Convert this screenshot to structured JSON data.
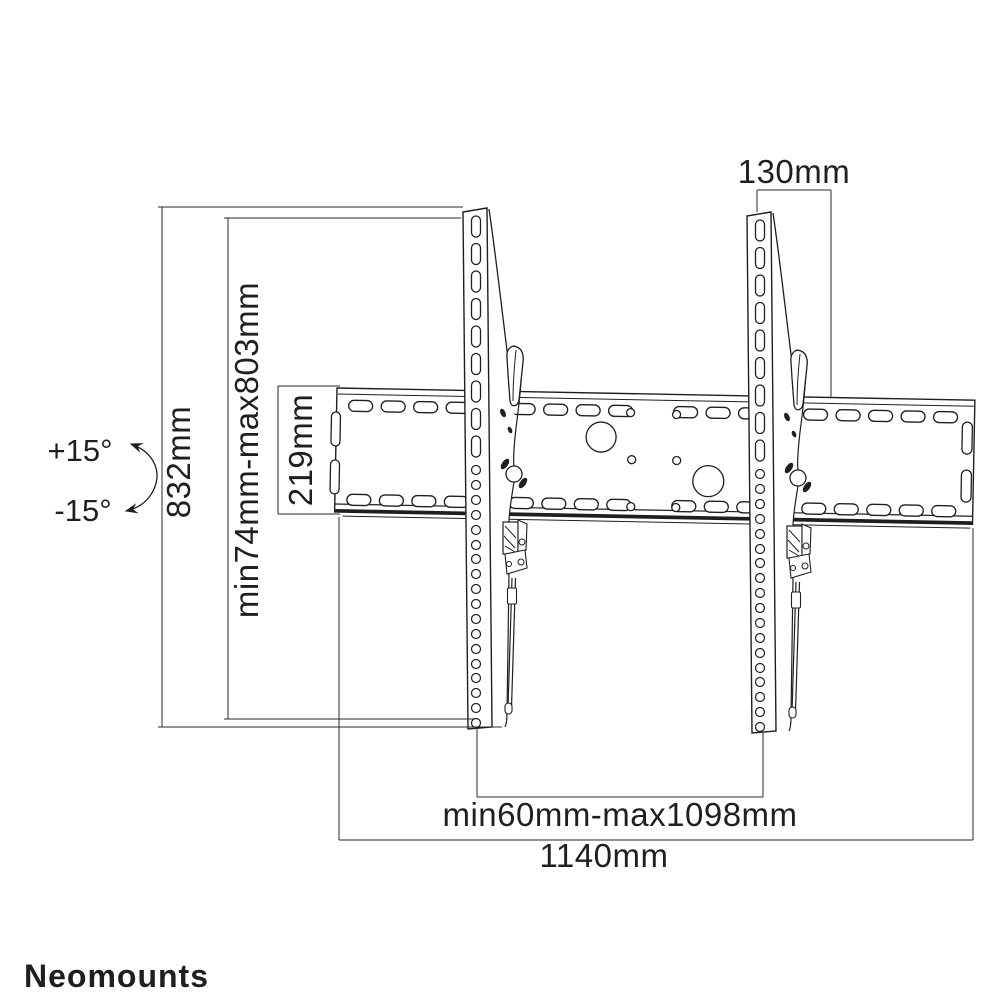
{
  "page": {
    "background": "#ffffff"
  },
  "drawing": {
    "subject": "tilting-tv-wall-mount-technical-drawing",
    "stroke_color": "#1f1f1f",
    "labels": {
      "tilt_up": "+15°",
      "tilt_down": "-15°",
      "total_height": "832mm",
      "height_range": "min74mm-max803mm",
      "plate_height": "219mm",
      "top_offset": "130mm",
      "width_range": "min60mm-max1098mm",
      "total_width": "1140mm"
    }
  },
  "footer": {
    "brand": "Neomounts",
    "brand_color": "#8b8b8b"
  }
}
